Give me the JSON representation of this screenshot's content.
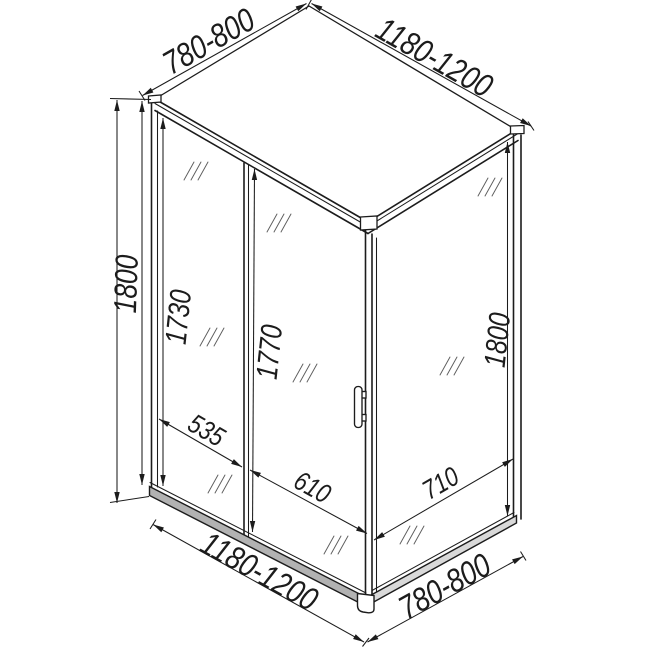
{
  "diagram": {
    "type": "shower-enclosure-technical-drawing",
    "dimensions": {
      "top_depth": "780-800",
      "top_width": "1180-1200",
      "overall_height": "1800",
      "fixed_panel_height": "1730",
      "door_height": "1770",
      "side_panel_height": "1800",
      "fixed_panel_width": "535",
      "door_width": "610",
      "side_panel_width": "710",
      "bottom_width": "1180-1200",
      "bottom_depth": "780-800"
    },
    "colors": {
      "line": "#1c1c1c",
      "front_rail_fill": "#b2b2b2",
      "side_rail_fill": "#d9d9d9",
      "background": "#ffffff"
    }
  }
}
